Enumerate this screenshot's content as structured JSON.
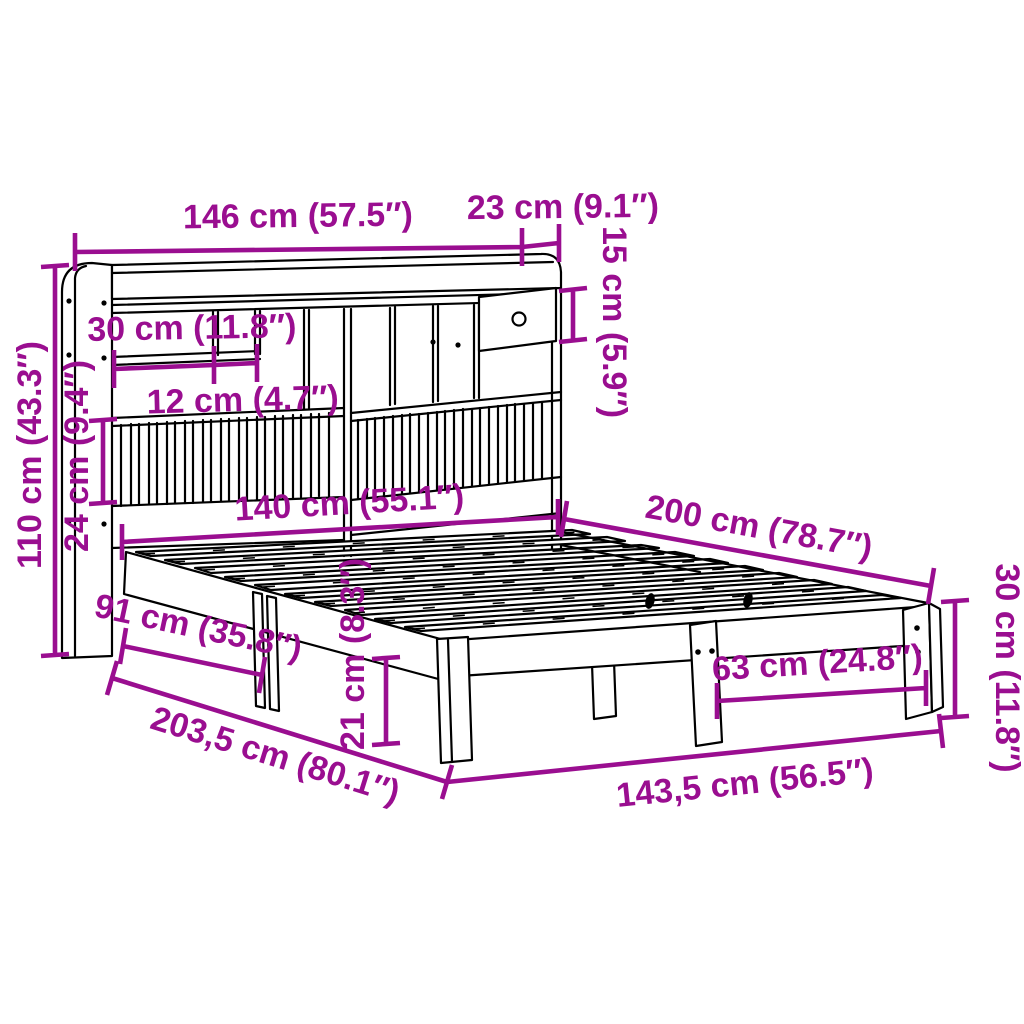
{
  "diagram": {
    "title": "Bed frame with bookcase headboard dimension diagram",
    "background_color": "#ffffff",
    "line_color": "#000000",
    "dimension_color": "#9a0e90",
    "dimensions": [
      {
        "id": "headboard-width",
        "label": "146 cm (57.5″)"
      },
      {
        "id": "headboard-top-depth",
        "label": "23 cm (9.1″)"
      },
      {
        "id": "drawer-height",
        "label": "15 cm (5.9″)"
      },
      {
        "id": "shelf-compartment",
        "label": "30 cm (11.8″)"
      },
      {
        "id": "shelf-gap",
        "label": "12 cm (4.7″)"
      },
      {
        "id": "slat-panel-height",
        "label": "24 cm (9.4″)"
      },
      {
        "id": "headboard-height",
        "label": "110 cm (43.3″)"
      },
      {
        "id": "bed-width",
        "label": "140 cm (55.1″)"
      },
      {
        "id": "bed-length",
        "label": "200 cm (78.7″)"
      },
      {
        "id": "frame-height",
        "label": "30 cm (11.8″)"
      },
      {
        "id": "leg-spacing",
        "label": "63 cm (24.8″)"
      },
      {
        "id": "side-leg-distance",
        "label": "91 cm (35.8″)"
      },
      {
        "id": "under-bed-clearance",
        "label": "21 cm (8.3″)"
      },
      {
        "id": "total-length",
        "label": "203,5 cm (80.1″)"
      },
      {
        "id": "total-width",
        "label": "143,5 cm (56.5″)"
      }
    ]
  }
}
